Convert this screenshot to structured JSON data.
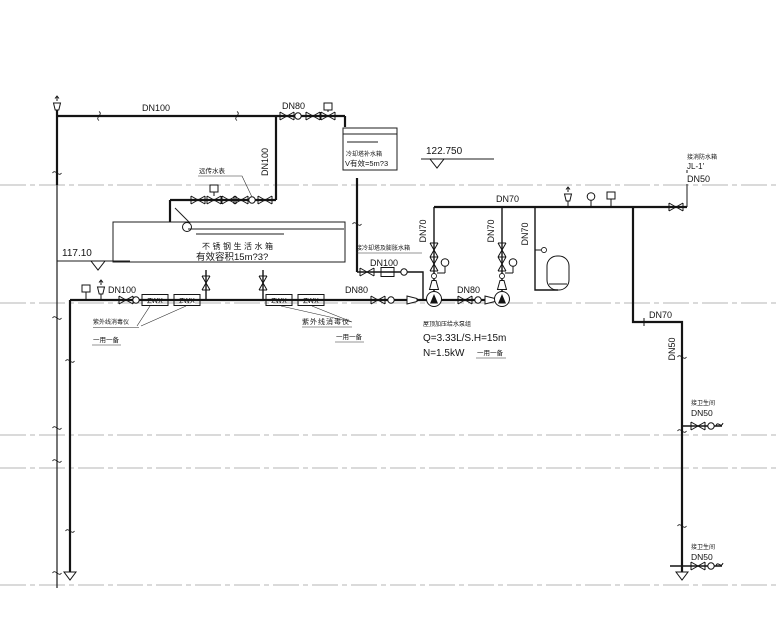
{
  "labels": {
    "dn100": "DN100",
    "dn80": "DN80",
    "dn70": "DN70",
    "dn50": "DN50"
  },
  "tanks": {
    "cooling": {
      "name": "冷却塔补水箱",
      "volume": "V有效=5m?3"
    },
    "domestic": {
      "name": "不锈钢生活水箱",
      "volume": "有效容积15m?3?"
    }
  },
  "elevations": {
    "roof": "122.750",
    "second": "117.10"
  },
  "pump_group": {
    "name": "屋顶加压给水泵组",
    "flow": "Q=3.33L/S.H=15m",
    "power": "N=1.5kW",
    "standby": "一用一备"
  },
  "uv_sterilizer": {
    "name": "紫外线消毒仪",
    "standby": "一用一备",
    "box_label": "ZWX"
  },
  "meter": {
    "label": "远传水表"
  },
  "cooling_feed": {
    "label": "接冷却塔及膨胀水箱"
  },
  "fire_connection": {
    "label": "接消防水箱",
    "riser_id": "JL-1'"
  },
  "washroom_connection": {
    "label": "接卫生间"
  }
}
